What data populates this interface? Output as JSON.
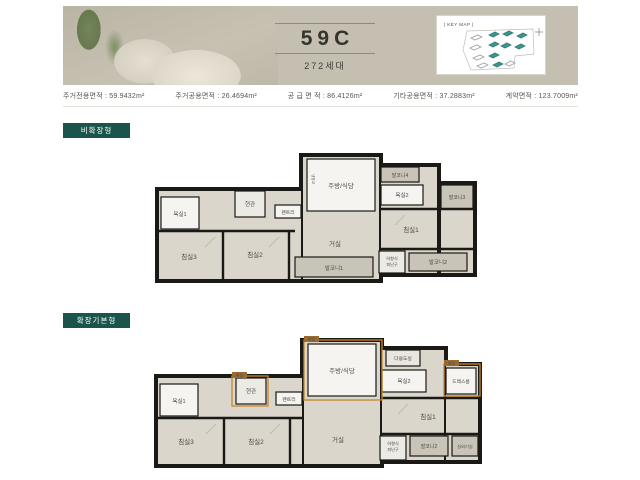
{
  "header": {
    "unit_name": "59C",
    "households": "272세대",
    "key_map_label": "| KEY MAP |"
  },
  "stats": [
    {
      "text": "주거전용면적 : 59.9432m²"
    },
    {
      "text": "주거공용면적 : 26.4694m²"
    },
    {
      "text": "공 급 면 적 : 86.4126m²"
    },
    {
      "text": "기타공용면적 : 37.2883m²"
    },
    {
      "text": "계약면적 : 123.7009m²"
    }
  ],
  "plans": {
    "plan1": {
      "badge": "비확장형",
      "rooms": {
        "bath1": "욕실1",
        "bed3": "침실3",
        "bed2": "침실2",
        "entrance": "현관",
        "pantry": "팬트리",
        "kitchen": "주방/식당",
        "fridge": "냉장고",
        "living": "거실",
        "balcony1": "발코니1",
        "balcony2": "발코니2",
        "balcony3": "발코니3",
        "balcony4": "발코니4",
        "bath2": "욕실2",
        "bed1": "침실1",
        "hatch1": "하향식",
        "hatch2": "피난구"
      }
    },
    "plan2": {
      "badge": "확장기본형",
      "rooms": {
        "bath1": "욕실1",
        "bed3": "침실3",
        "bed2": "침실2",
        "entrance": "현관",
        "pantry": "팬트리",
        "kitchen": "주방/식당",
        "utility": "다용도실",
        "bath2": "욕실2",
        "dress": "드레스룸",
        "bed1": "침실1",
        "living": "거실",
        "balcony2": "발코니2",
        "outdoor": "실외기실",
        "hatch1": "하향식",
        "hatch2": "피난구",
        "expand_tag": "확장"
      }
    }
  },
  "colors": {
    "badge_teal": "#1a544b",
    "expansion_orange": "#c8862a",
    "header_beige": "#c5bfb1",
    "wall_black": "#1a1916",
    "room_beige": "#dbd6cb",
    "balcony_gray": "#c9c4b8"
  }
}
